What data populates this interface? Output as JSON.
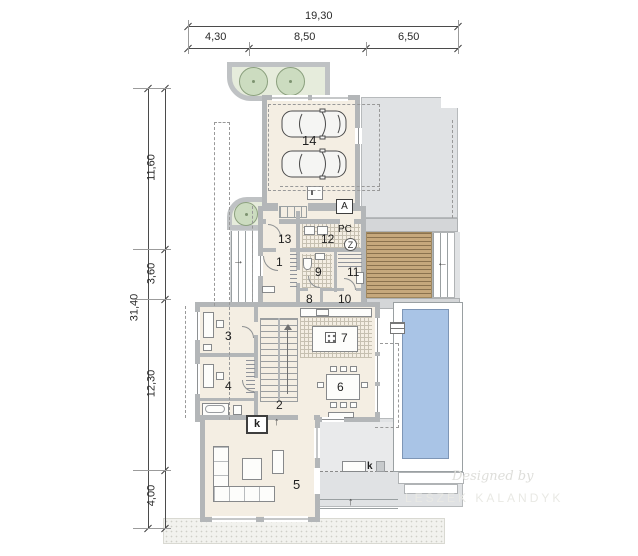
{
  "dimensions": {
    "top_total": "19,30",
    "top_seg_1": "4,30",
    "top_seg_2": "8,50",
    "top_seg_3": "6,50",
    "left_total": "31,40",
    "left_seg_1": "11,60",
    "left_seg_2": "3,60",
    "left_seg_3": "12,30",
    "left_seg_4": "4,00"
  },
  "rooms": {
    "r1": "1",
    "r2": "2",
    "r3": "3",
    "r4": "4",
    "r5": "5",
    "r6": "6",
    "r7": "7",
    "r8": "8",
    "r9": "9",
    "r10": "10",
    "r11": "11",
    "r12": "12",
    "r13": "13",
    "r14": "14"
  },
  "markers": {
    "utility_label": "PC",
    "section_marker": "A",
    "boiler_symbol": "Z",
    "fireplace_label": "k",
    "terrace_fireplace_label": "k"
  },
  "arrows": {
    "entry": "→",
    "deck": "←",
    "terrace_steps": "↑",
    "living_flue": "↑"
  },
  "watermark": {
    "line1": "Designed by",
    "line2": "LESZEK KALANDYK"
  },
  "colors": {
    "interior": "#f4eee3",
    "wall": "#b3b6b8",
    "paving": "#e0e2e4",
    "deck": "#c6a87c",
    "pool": "#a9c4e6",
    "planter": "#e6ecdc"
  }
}
